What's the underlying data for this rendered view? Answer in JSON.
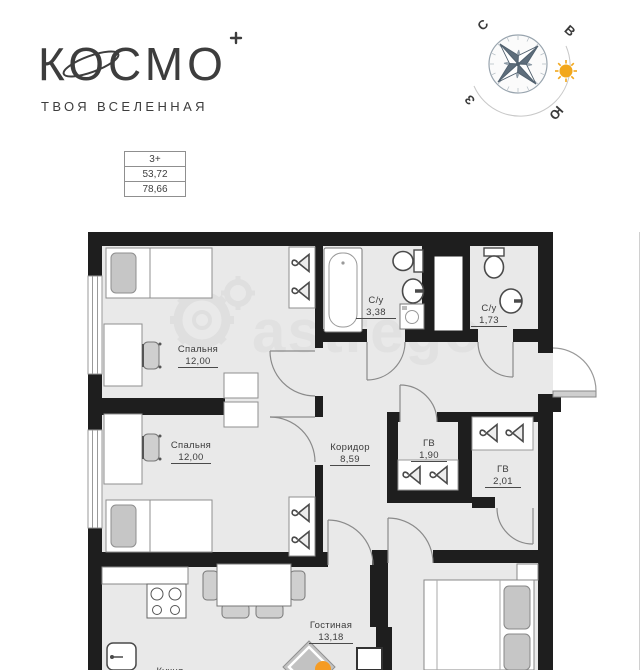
{
  "brand": {
    "logo_text": "КОСМО",
    "tagline": "ТВОЯ ВСЕЛЕННАЯ"
  },
  "compass": {
    "n": "С",
    "e": "В",
    "s": "Ю",
    "w": "З"
  },
  "info_table": {
    "rooms": "3+",
    "living_area": "53,72",
    "total_area": "78,66"
  },
  "watermark": "astrego",
  "rooms": {
    "bedroom1": {
      "name": "Спальня",
      "area": "12,00"
    },
    "bedroom2": {
      "name": "Спальня",
      "area": "12,00"
    },
    "bathroom1": {
      "name": "С/у",
      "area": "3,38"
    },
    "bathroom2": {
      "name": "С/у",
      "area": "1,73"
    },
    "corridor": {
      "name": "Коридор",
      "area": "8,59"
    },
    "wardrobe1": {
      "name": "ГВ",
      "area": "1,90"
    },
    "wardrobe2": {
      "name": "ГВ",
      "area": "2,01"
    },
    "living": {
      "name": "Гостиная",
      "area": "13,18"
    },
    "kitchen": {
      "name": "Кухня"
    }
  },
  "colors": {
    "wall": "#1e1e1e",
    "floor": "#e9e9e9",
    "sun": "#f2a71b",
    "decor_orange": "#f59b23",
    "label": "#3c3c3c"
  }
}
